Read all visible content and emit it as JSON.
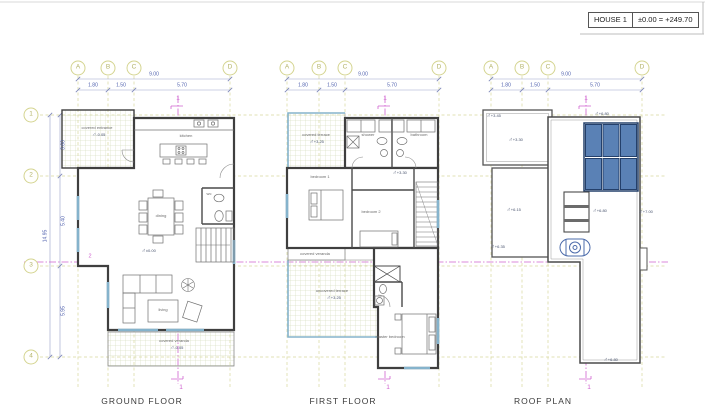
{
  "title_block": {
    "house_label": "HOUSE 1",
    "datum_label": "±0.00 = +249.70"
  },
  "grid": {
    "columns": [
      "A",
      "B",
      "C",
      "D"
    ],
    "col_total": "9.00",
    "col_segments": [
      "1.80",
      "1.50",
      "5.70"
    ],
    "rows": [
      "1",
      "2",
      "3",
      "4"
    ],
    "row_total": "14.95",
    "row_segments": [
      "3.60",
      "5.40",
      "5.95"
    ],
    "section_vertical": "1",
    "section_horizontal": "2"
  },
  "plans": {
    "ground": {
      "title": "GROUND FLOOR",
      "labels": {
        "entrance": "covered entrance",
        "entrance_level": "-0.05",
        "kitchen": "kitchen",
        "dining": "dining",
        "wc": "wc",
        "floor_level": "±0.00",
        "living": "living",
        "veranda": "covered veranda",
        "veranda_level": "-0.05"
      }
    },
    "first": {
      "title": "FIRST FLOOR",
      "labels": {
        "terrace": "covered terrace",
        "terrace_level": "+3.25",
        "bath_left": "shower",
        "bath_right": "bathroom",
        "hall_level": "+3.30",
        "bedroom1": "bedroom 1",
        "bedroom2": "bedroom 2",
        "balcony": "covered veranda",
        "uncovered": "uncovered terrace",
        "uncovered_level": "+3.25",
        "master": "master bedroom"
      }
    },
    "roof": {
      "title": "ROOF PLAN",
      "levels": {
        "entrance_roof": "+3.45",
        "canopy": "+3.30",
        "annex": "+6.15",
        "annex_low": "+6.35",
        "main_top": "+6.80",
        "main_mid": "+6.80",
        "parapet_right": "+7.00",
        "main_bottom": "+6.80"
      }
    }
  },
  "colors": {
    "grid_olive": "#d8d89c",
    "dimension_blue": "#5061ae",
    "section_magenta": "#cf63cf",
    "wall_dark": "#3f3f3f",
    "solar_panel_blue": "#5a81b5",
    "terrace_blue": "#85b3cc"
  }
}
